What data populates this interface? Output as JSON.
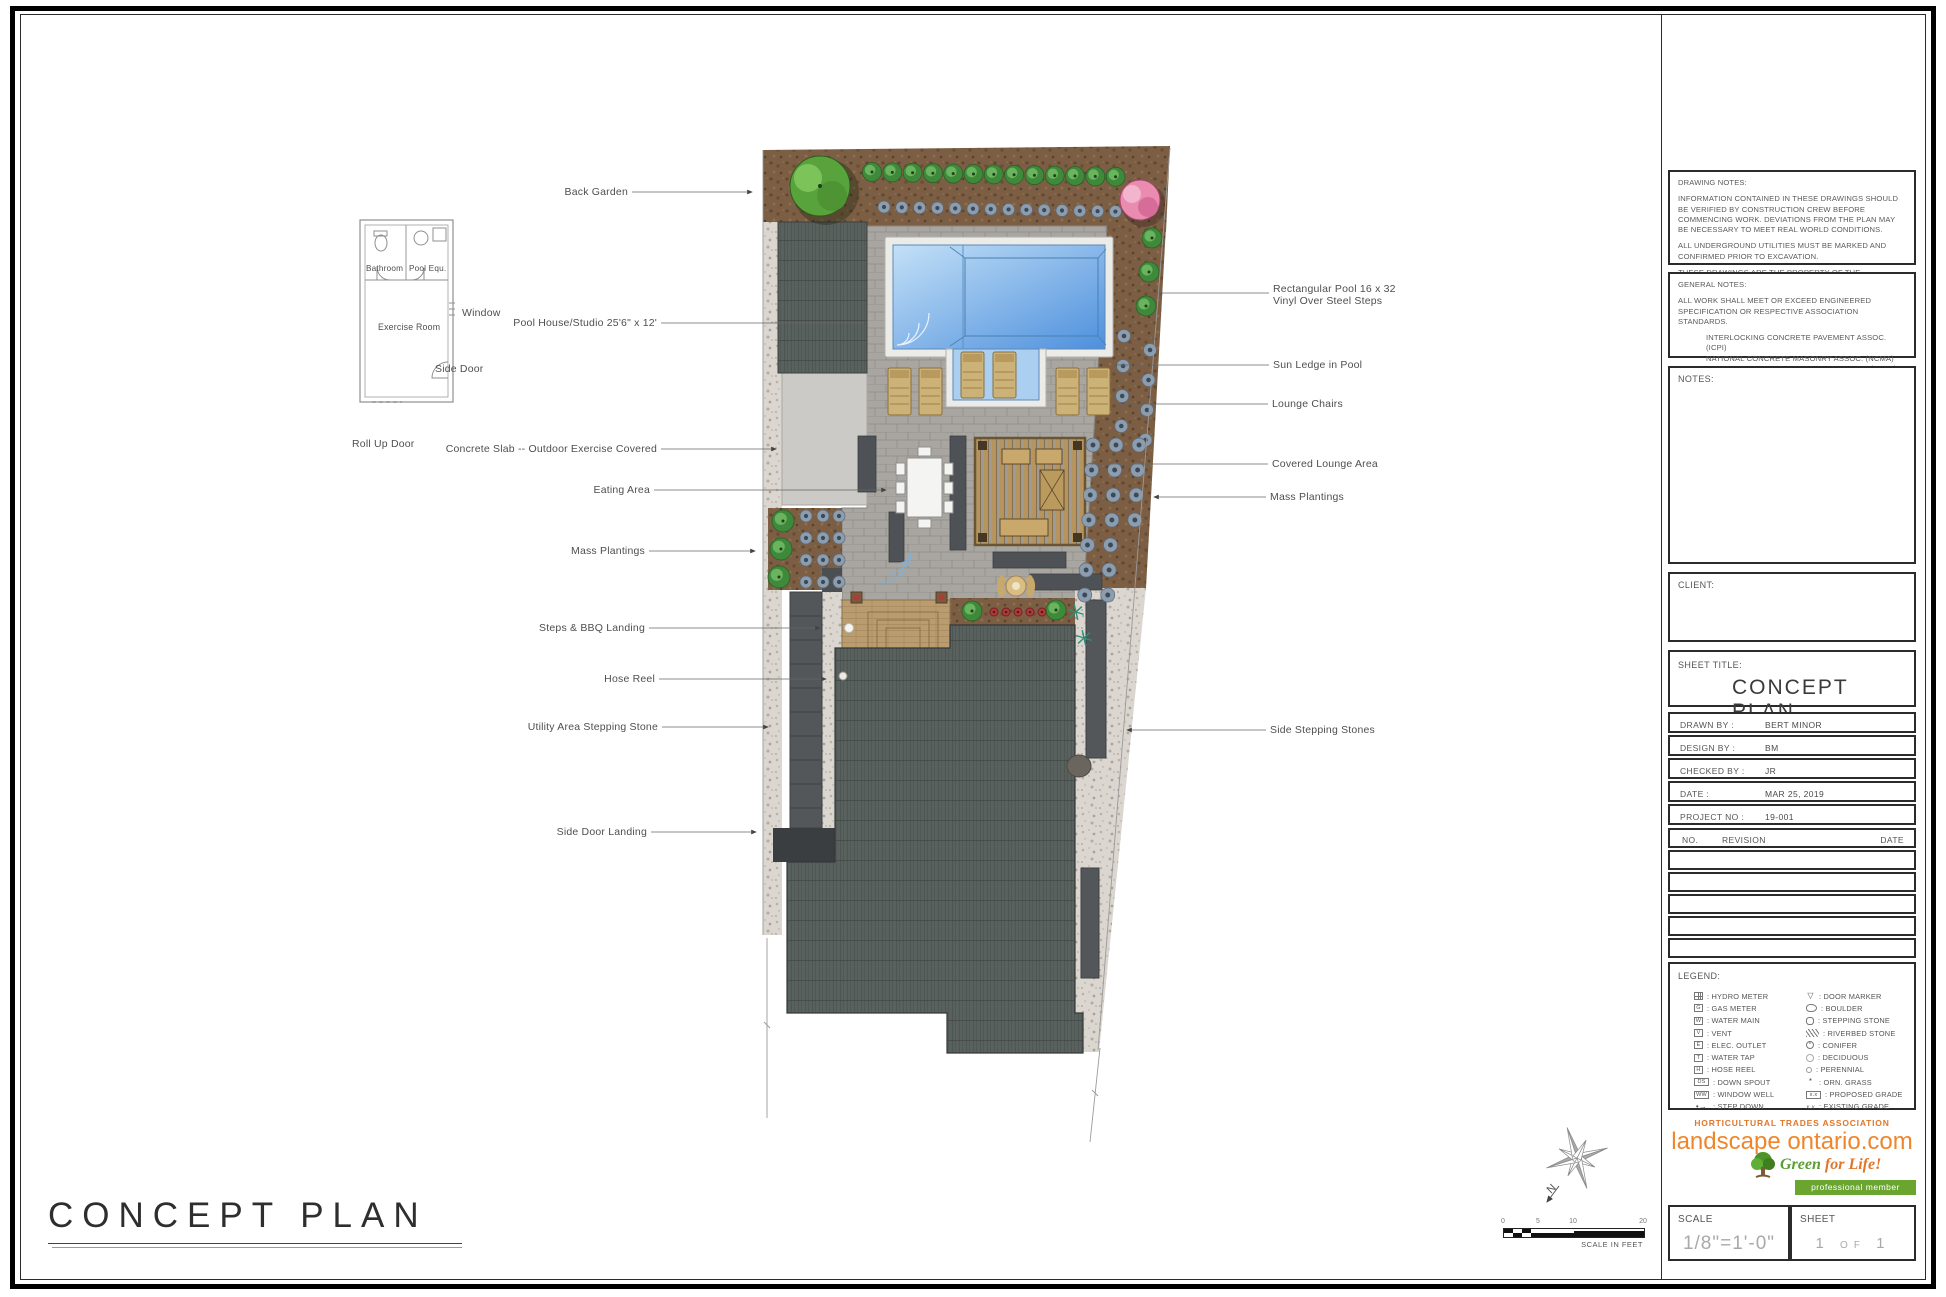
{
  "plan": {
    "title": "CONCEPT PLAN",
    "compass_label": "N",
    "scale_bar": {
      "ticks": [
        "0",
        "5",
        "10",
        "20"
      ],
      "caption": "SCALE IN FEET"
    },
    "callouts_left": [
      {
        "text": "Back Garden"
      },
      {
        "text": "Pool House/Studio 25'6\" x 12'"
      },
      {
        "text": "Concrete Slab -- Outdoor Exercise Covered"
      },
      {
        "text": "Eating Area"
      },
      {
        "text": "Mass Plantings"
      },
      {
        "text": "Steps & BBQ Landing"
      },
      {
        "text": "Hose Reel"
      },
      {
        "text": "Utility Area Stepping Stone"
      },
      {
        "text": "Side Door Landing"
      }
    ],
    "callouts_right": [
      {
        "text": "Rectangular Pool 16 x 32\nVinyl Over Steel Steps"
      },
      {
        "text": "Sun Ledge in Pool"
      },
      {
        "text": "Lounge Chairs"
      },
      {
        "text": "Covered Lounge Area"
      },
      {
        "text": "Mass Plantings"
      },
      {
        "text": "Side Stepping Stones"
      }
    ],
    "inset": {
      "room_labels": [
        "Bathroom",
        "Pool Equ.",
        "Exercise Room"
      ],
      "callouts": [
        "Window",
        "Side Door",
        "Roll Up Door"
      ]
    }
  },
  "title_block": {
    "drawing_notes": {
      "label": "DRAWING NOTES:",
      "paragraphs": [
        "INFORMATION CONTAINED IN THESE DRAWINGS SHOULD BE VERIFIED BY CONSTRUCTION CREW BEFORE COMMENCING WORK. DEVIATIONS FROM THE PLAN MAY BE NECESSARY TO MEET REAL WORLD CONDITIONS.",
        "ALL UNDERGROUND UTILITIES MUST BE MARKED AND CONFIRMED PRIOR TO EXCAVATION.",
        "THESE DRAWINGS ARE THE PROPERTY OF THE LANDSCAPE DESIGNER AND MAY NOT BE REPRODUCED WITHOUT WRITTEN CONSENT PERSUANT TO COPYRIGHT LAWS."
      ]
    },
    "general_notes": {
      "label": "GENERAL NOTES:",
      "intro": "ALL WORK SHALL MEET OR EXCEED ENGINEERED SPECIFICATION OR RESPECTIVE ASSOCIATION STANDARDS.",
      "standards": [
        "INTERLOCKING CONCRETE PAVEMENT ASSOC. (ICPI)",
        "NATIONAL CONCRETE MASONRY ASSOC. (NCMA)",
        "CANADIAN NATIONAL LANDSCAPE ASSOC. (CNLA)",
        "POOL AND HOT TUB COUNCIL OF CANADA (PHTCC)"
      ],
      "outro": "ALL APPLICABLE PERMITS SHOULD BE IN PLACE BEFORE START OF PROJECT."
    },
    "notes_label": "NOTES:",
    "client_label": "CLIENT:",
    "sheet_title_label": "SHEET TITLE:",
    "sheet_title": "CONCEPT PLAN",
    "info_rows": [
      {
        "label": "DRAWN BY :",
        "value": "BERT MINOR"
      },
      {
        "label": "DESIGN BY :",
        "value": "BM"
      },
      {
        "label": "CHECKED BY :",
        "value": "JR"
      },
      {
        "label": "DATE :",
        "value": "MAR 25, 2019"
      },
      {
        "label": "PROJECT NO :",
        "value": "19-001"
      }
    ],
    "revision_header": {
      "no": "NO.",
      "revision": "REVISION",
      "date": "DATE"
    },
    "revision_empty_rows": 5,
    "legend": {
      "label": "LEGEND:",
      "left": [
        {
          "icon": "hydro-meter",
          "label": "HYDRO METER"
        },
        {
          "icon": "gas-meter",
          "label": "GAS METER"
        },
        {
          "icon": "water-main",
          "label": "WATER MAIN"
        },
        {
          "icon": "vent",
          "label": "VENT"
        },
        {
          "icon": "elec-outlet",
          "label": "ELEC. OUTLET"
        },
        {
          "icon": "water-tap",
          "label": "WATER TAP"
        },
        {
          "icon": "hose-reel",
          "label": "HOSE REEL"
        },
        {
          "icon": "down-spout",
          "label": "DOWN SPOUT"
        },
        {
          "icon": "window-well",
          "label": "WINDOW WELL"
        },
        {
          "icon": "step-down",
          "label": "STEP DOWN"
        }
      ],
      "right": [
        {
          "icon": "door-marker",
          "label": "DOOR MARKER"
        },
        {
          "icon": "boulder",
          "label": "BOULDER"
        },
        {
          "icon": "stepping-stone",
          "label": "STEPPING STONE"
        },
        {
          "icon": "riverbed-stone",
          "label": "RIVERBED STONE"
        },
        {
          "icon": "conifer",
          "label": "CONIFER"
        },
        {
          "icon": "deciduous",
          "label": "DECIDUOUS"
        },
        {
          "icon": "perennial",
          "label": "PERENNIAL"
        },
        {
          "icon": "orn-grass",
          "label": "ORN. GRASS"
        },
        {
          "icon": "proposed-grade",
          "label": "PROPOSED GRADE"
        },
        {
          "icon": "existing-grade",
          "label": "EXISTING GRADE"
        }
      ]
    },
    "logo": {
      "line1": "HORTICULTURAL TRADES ASSOCIATION",
      "brand": "landscape ontario.com",
      "script_green": "Green",
      "script_orange": " for Life!",
      "member": "professional member",
      "orange": "#ef862b",
      "green": "#6aa52f"
    },
    "scale_box": {
      "label": "SCALE",
      "value": "1/8\"=1'-0\""
    },
    "sheet_box": {
      "label": "SHEET",
      "num": "1",
      "of": "OF",
      "total": "1"
    }
  }
}
